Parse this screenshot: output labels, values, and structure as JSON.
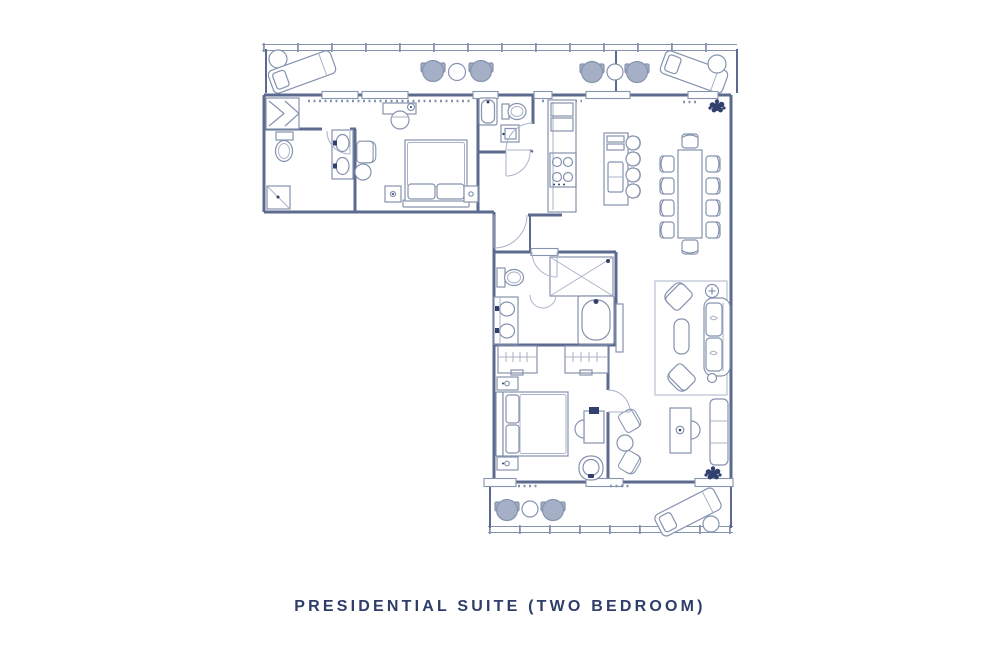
{
  "title": "PRESIDENTIAL SUITE (TWO BEDROOM)",
  "colors": {
    "background": "#ffffff",
    "wall": "#5b6a8e",
    "furniture": "#8593ae",
    "furniture_light": "#aab3c8",
    "seat_fill": "#a5afc5",
    "plant": "#31406d",
    "title_text": "#2e3d69"
  }
}
